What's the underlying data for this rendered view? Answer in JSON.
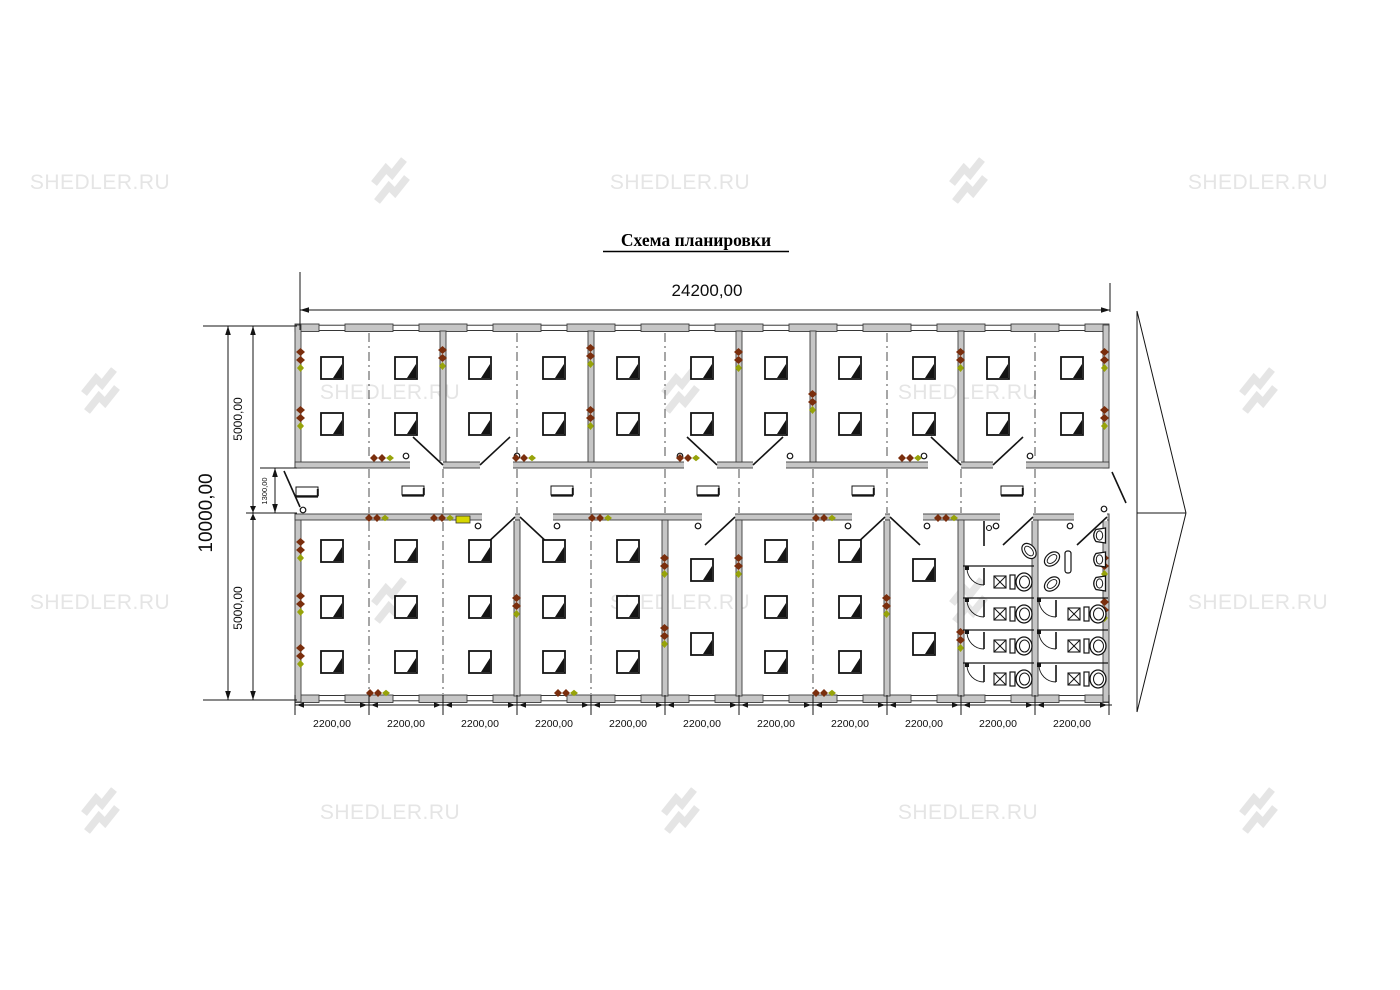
{
  "title": "Схема планировки",
  "watermark": {
    "text": "SHEDLER.RU"
  },
  "dimensions": {
    "total_width": "24200,00",
    "total_height": "10000,00",
    "top_section_height": "5000,00",
    "bottom_section_height": "5000,00",
    "corridor_width": "1300,00",
    "modules": [
      "2200,00",
      "2200,00",
      "2200,00",
      "2200,00",
      "2200,00",
      "2200,00",
      "2200,00",
      "2200,00",
      "2200,00",
      "2200,00",
      "2200,00"
    ]
  },
  "colors": {
    "wall_gray": "#c6c6c6",
    "line_black": "#141414",
    "heater_red": "#7a2e0d",
    "accent_green": "#97a30a",
    "highlight_yellow": "#d6d600",
    "watermark_gray": "#e5e5e5"
  }
}
